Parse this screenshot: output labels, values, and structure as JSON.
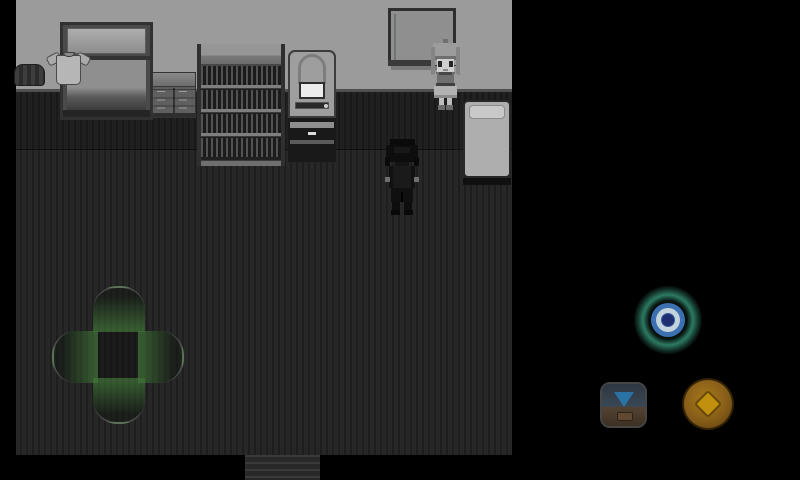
{
  "app": {
    "type": "rpg-maker-mobile-game",
    "scene": "dark monochrome bedroom, top-down RPG view with on-screen touch controls",
    "visible_text": "none"
  },
  "palette": {
    "bg": "#000000",
    "wall": "#9b9b9b",
    "floor-base": "#272727",
    "floor-stripe": "#1e1e1e",
    "dpad-glow": "#427e38",
    "teal": "#2c7a64",
    "ablue": "#3c70b0",
    "apale": "#c3d4dc",
    "anavy": "#1e2f70",
    "carrow": "#2f80ba",
    "coin": "#d09b10"
  },
  "room": {
    "furniture": [
      {
        "name": "wardrobe",
        "desc": "open closet with shirt and dark bundle"
      },
      {
        "name": "dresser",
        "desc": "six-drawer chest"
      },
      {
        "name": "bookshelf",
        "desc": "four shelves full of books"
      },
      {
        "name": "computer-desk",
        "desc": "station with chair-back, white screen and base"
      },
      {
        "name": "window",
        "desc": "two-pane sliding window with glare"
      },
      {
        "name": "bed",
        "desc": "light mattress with pillow, vertical"
      },
      {
        "name": "doormat",
        "desc": "exit mat at bottom center"
      }
    ]
  },
  "characters": [
    {
      "name": "npc-girl",
      "desc": "gray-scale girl with hair bun standing by the window"
    },
    {
      "name": "player",
      "desc": "dark silhouetted character facing away, center of room"
    }
  ],
  "controls": {
    "dpad": {
      "name": "virtual-dpad",
      "directions": [
        "up",
        "down",
        "left",
        "right"
      ],
      "glow": "green"
    },
    "buttons": [
      {
        "name": "action-button",
        "icon": "target-rings-icon",
        "colors": [
          "teal",
          "blue",
          "pale",
          "navy"
        ]
      },
      {
        "name": "chest-button",
        "icon": "down-arrow-into-chest-icon",
        "colors": [
          "blue",
          "brown"
        ]
      },
      {
        "name": "menu-button",
        "icon": "diamond-icon",
        "colors": [
          "amber"
        ]
      }
    ]
  }
}
